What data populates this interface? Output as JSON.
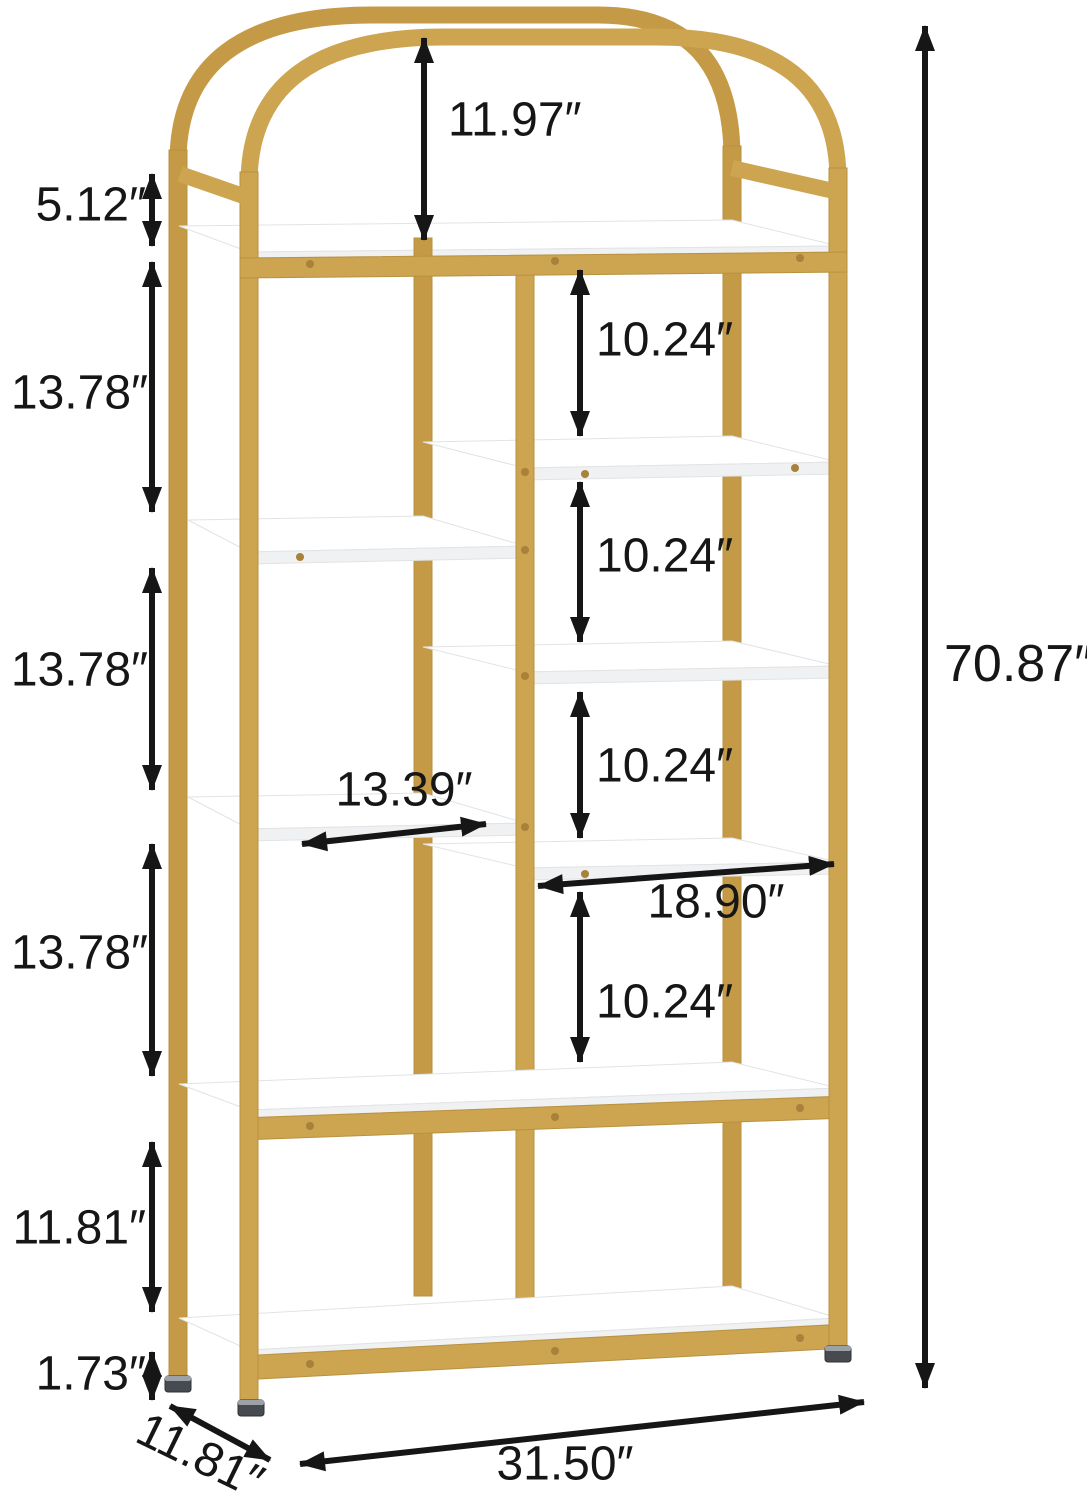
{
  "diagram": {
    "kind": "bookshelf-dimension-diagram",
    "labels": {
      "arch_height": "11.97″",
      "top_frame_height": "5.12″",
      "left_gap_1": "13.78″",
      "left_gap_2": "13.78″",
      "left_gap_3": "13.78″",
      "lower_section_height": "11.81″",
      "base_height": "1.73″",
      "right_gap_1": "10.24″",
      "right_gap_2": "10.24″",
      "right_gap_3": "10.24″",
      "right_gap_4": "10.24″",
      "left_shelf_width": "13.39″",
      "right_shelf_width": "18.90″",
      "overall_height": "70.87″",
      "overall_width": "31.50″",
      "overall_depth": "11.81″"
    },
    "colors": {
      "background": "#FFFFFF",
      "frame_gold": "#CDA450",
      "frame_gold_back": "#C59A46",
      "frame_gold_dark": "#B8923F",
      "screw_gold": "#A8813A",
      "shelf_white": "#FFFFFF",
      "shelf_face": "#F0F1F2",
      "shelf_edge": "#E2E3E5",
      "dimension_line": "#161616",
      "foot_dark": "#474B50",
      "foot_rim": "#9BA1A7"
    }
  }
}
